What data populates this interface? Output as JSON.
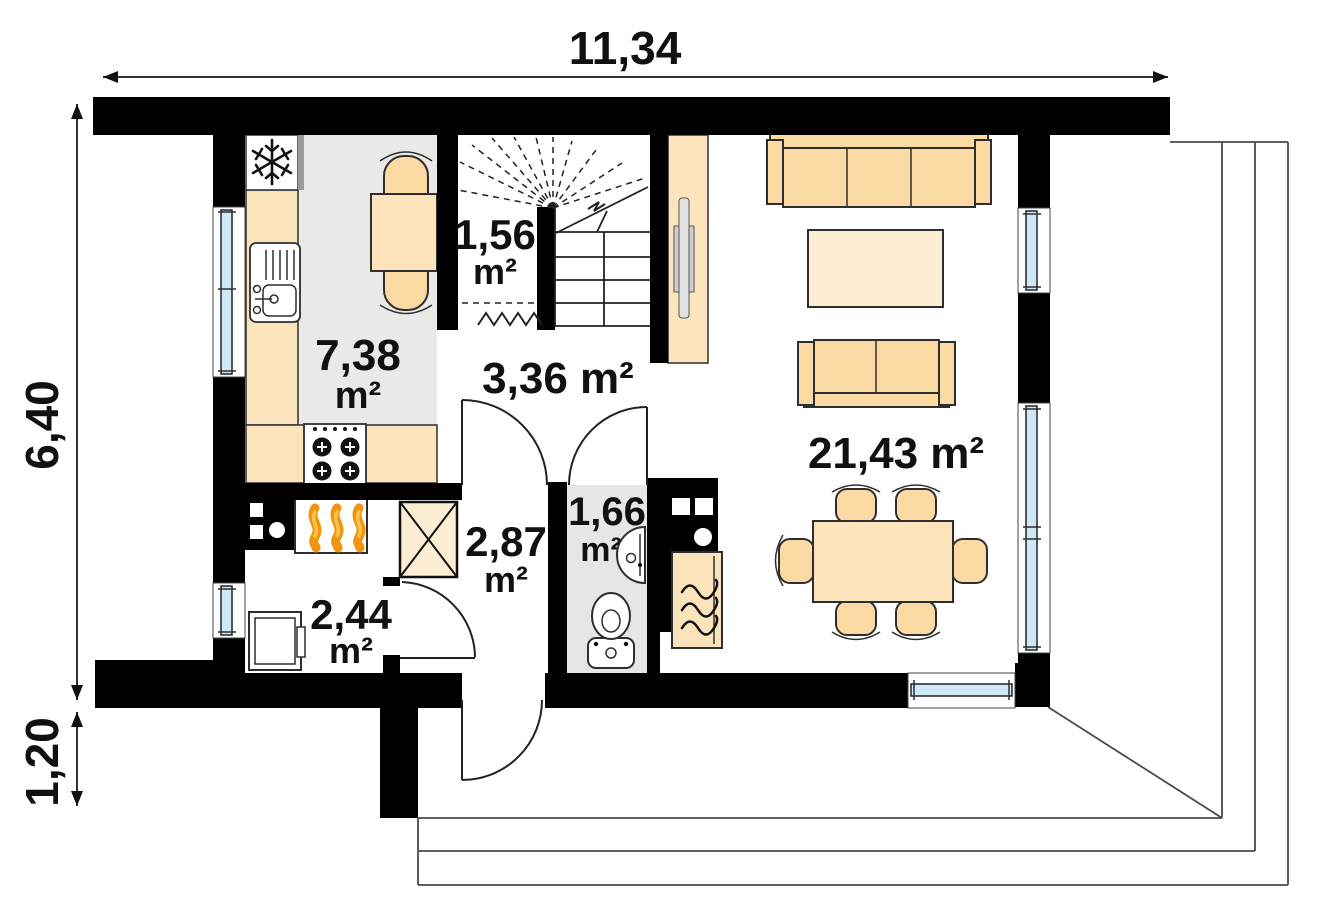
{
  "plan": {
    "type": "house-ground-floor-plan",
    "dimensions": {
      "width_label": "11,34",
      "height_label": "6,40",
      "porch_depth_label": "1,20"
    },
    "rooms": {
      "kitchen": {
        "value": "7,38",
        "unit": "m²"
      },
      "under_stairs": {
        "value": "1,56",
        "unit": "m²"
      },
      "hall": {
        "label": "3,36 m²"
      },
      "corridor": {
        "value": "2,87",
        "unit": "m²"
      },
      "wc": {
        "value": "1,66",
        "unit": "m²"
      },
      "boiler_room": {
        "value": "2,44",
        "unit": "m²"
      },
      "living_room": {
        "label": "21,43 m²"
      }
    },
    "colors": {
      "wall": "#000000",
      "furniture": "#fbd9a2",
      "furniture_light": "#fbe3bb",
      "furniture_pale": "#fdeed3",
      "kitchen_floor": "#e9e9e7",
      "wc_floor": "#e6e6e6",
      "window_glass": "#cfe8f7",
      "flame_orange": "#ef950f"
    },
    "icons": [
      "snowflake-fridge-icon",
      "sink-icon",
      "stove-burners-icon",
      "furnace-flame-icon",
      "fireplace-flame-icon",
      "washing-machine-icon",
      "toilet-icon",
      "washbasin-icon",
      "shaft-x-icon",
      "stairs-icon",
      "wardrobe-icon",
      "sofa-icon",
      "dining-set-icon"
    ]
  }
}
